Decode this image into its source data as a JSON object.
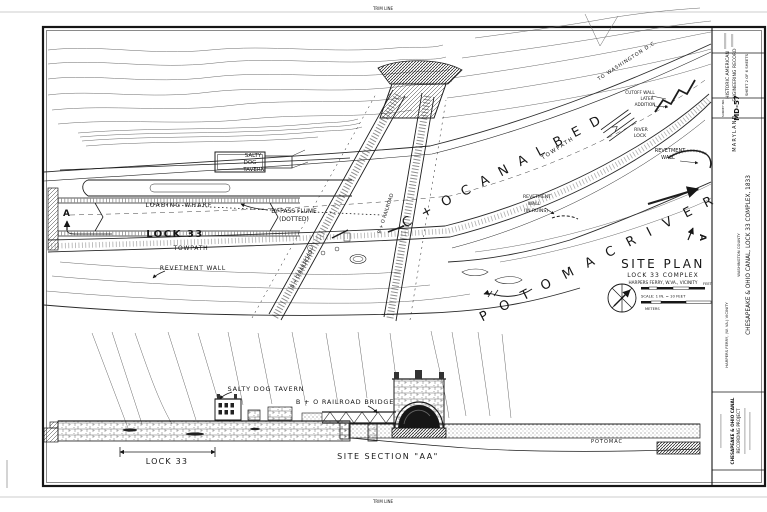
{
  "trim": {
    "top": "TRIM LINE",
    "bottom": "TRIM LINE"
  },
  "plan": {
    "labels": {
      "salty1": "SALTY",
      "salty2": "DOG",
      "salty3": "TAVERN",
      "loading_wharf": "LOADING  WHARF",
      "lock33": "LOCK 33",
      "bypass1": "BY-PASS FLUME",
      "bypass2": "(DOTTED)",
      "towpath": "TOWPATH",
      "revetment": "REVETMENT  WALL",
      "bo_rr": "B + O  RAILROAD",
      "canal_bed": "C + O  C A N A L   B E D",
      "towpath_r": "TOWPATH",
      "to_washington": "TO  WASHINGTON  D.C.",
      "cutoff1": "CUTOFF WALL",
      "cutoff2": "LATER",
      "cutoff3": "ADDITION",
      "river1": "RIVER",
      "river2": "LOCK",
      "rev_r1": "REVETMENT",
      "rev_r2": "WALL",
      "ruins1": "REVETMENT",
      "ruins2": "WALL",
      "ruins3": "(IN RUINS)",
      "potomac_river": "P O T O M A C   R I V E R",
      "marker_a": "A"
    },
    "titleblock": {
      "title": "SITE  PLAN",
      "subtitle": "LOCK 33  COMPLEX",
      "vicinity": "HARPERS FERRY, W.VA., VICINITY",
      "scale_note": "SCALE: 1 IN. = 10 FEET",
      "feet": "FEET",
      "meters": "METERS"
    }
  },
  "section": {
    "title": "SITE  SECTION  \"AA\"",
    "tavern": "SALTY  DOG  TAVERN",
    "bridge": "B + O  RAILROAD  BRIDGE",
    "lock33": "LOCK 33",
    "potomac": "POTOMAC"
  },
  "strip": {
    "record1": "HISTORIC AMERICAN",
    "record2": "ENGINEERING RECORD",
    "sheet_no": "SHEET 2 OF 6 SHEETS",
    "survey_label": "SURVEY NO.",
    "survey_no": "MD-57",
    "state": "MARYLAND",
    "main_title": "CHESAPEAKE & OHIO CANAL, LOCK 33 COMPLEX, 1833",
    "county": "WASHINGTON COUNTY",
    "vicinity": "HARPERS FERRY, (W. VA.) VICINITY",
    "project1": "CHESAPEAKE & OHIO CANAL",
    "project2": "RECORDING PROJECT"
  }
}
